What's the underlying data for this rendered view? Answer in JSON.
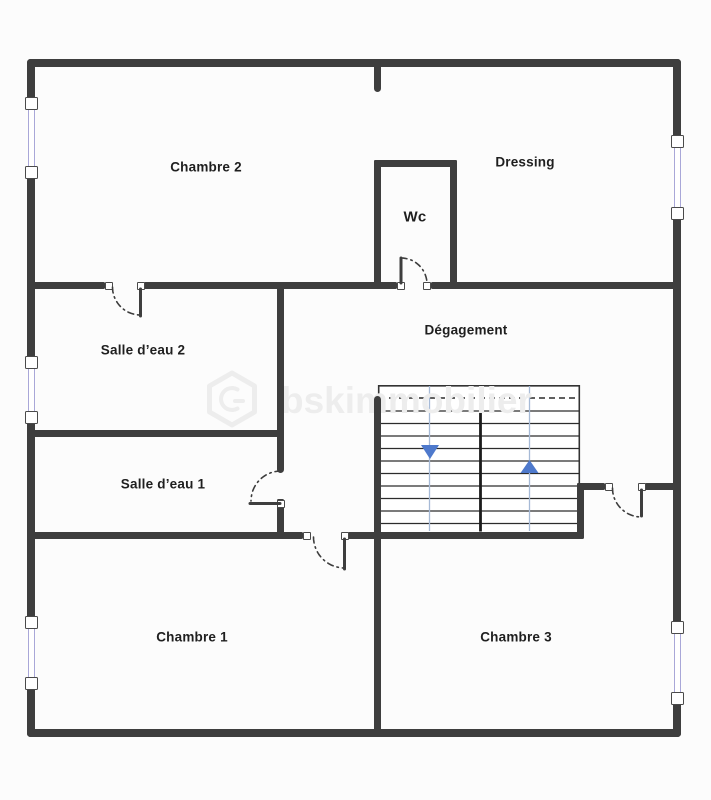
{
  "rooms": {
    "chambre2": {
      "label": "Chambre 2"
    },
    "dressing": {
      "label": "Dressing"
    },
    "wc": {
      "label": "Wc"
    },
    "salle_eau_2": {
      "label": "Salle d’eau 2"
    },
    "degagement": {
      "label": "Dégagement"
    },
    "salle_eau_1": {
      "label": "Salle d’eau 1"
    },
    "chambre1": {
      "label": "Chambre 1"
    },
    "chambre3": {
      "label": "Chambre 3"
    }
  },
  "stairs": {
    "flights": 2,
    "down_arrow_icon": "arrow-down",
    "up_arrow_icon": "arrow-up"
  },
  "watermark": {
    "logo_icon": "hexagon-logo",
    "text": "bskimmobilier"
  },
  "colors": {
    "background": "#fcfcfc",
    "wall": "#3e3e3e",
    "step_line": "#2c2c2c",
    "stair_outline": "#333333",
    "stair_guide": "#a6bad6",
    "arrow_blue": "#4e79cc",
    "door_arc": "#3d3d3d",
    "window_glass": "#a9a7d8",
    "watermark": "#ededed",
    "label_text": "#1f1f1f"
  }
}
